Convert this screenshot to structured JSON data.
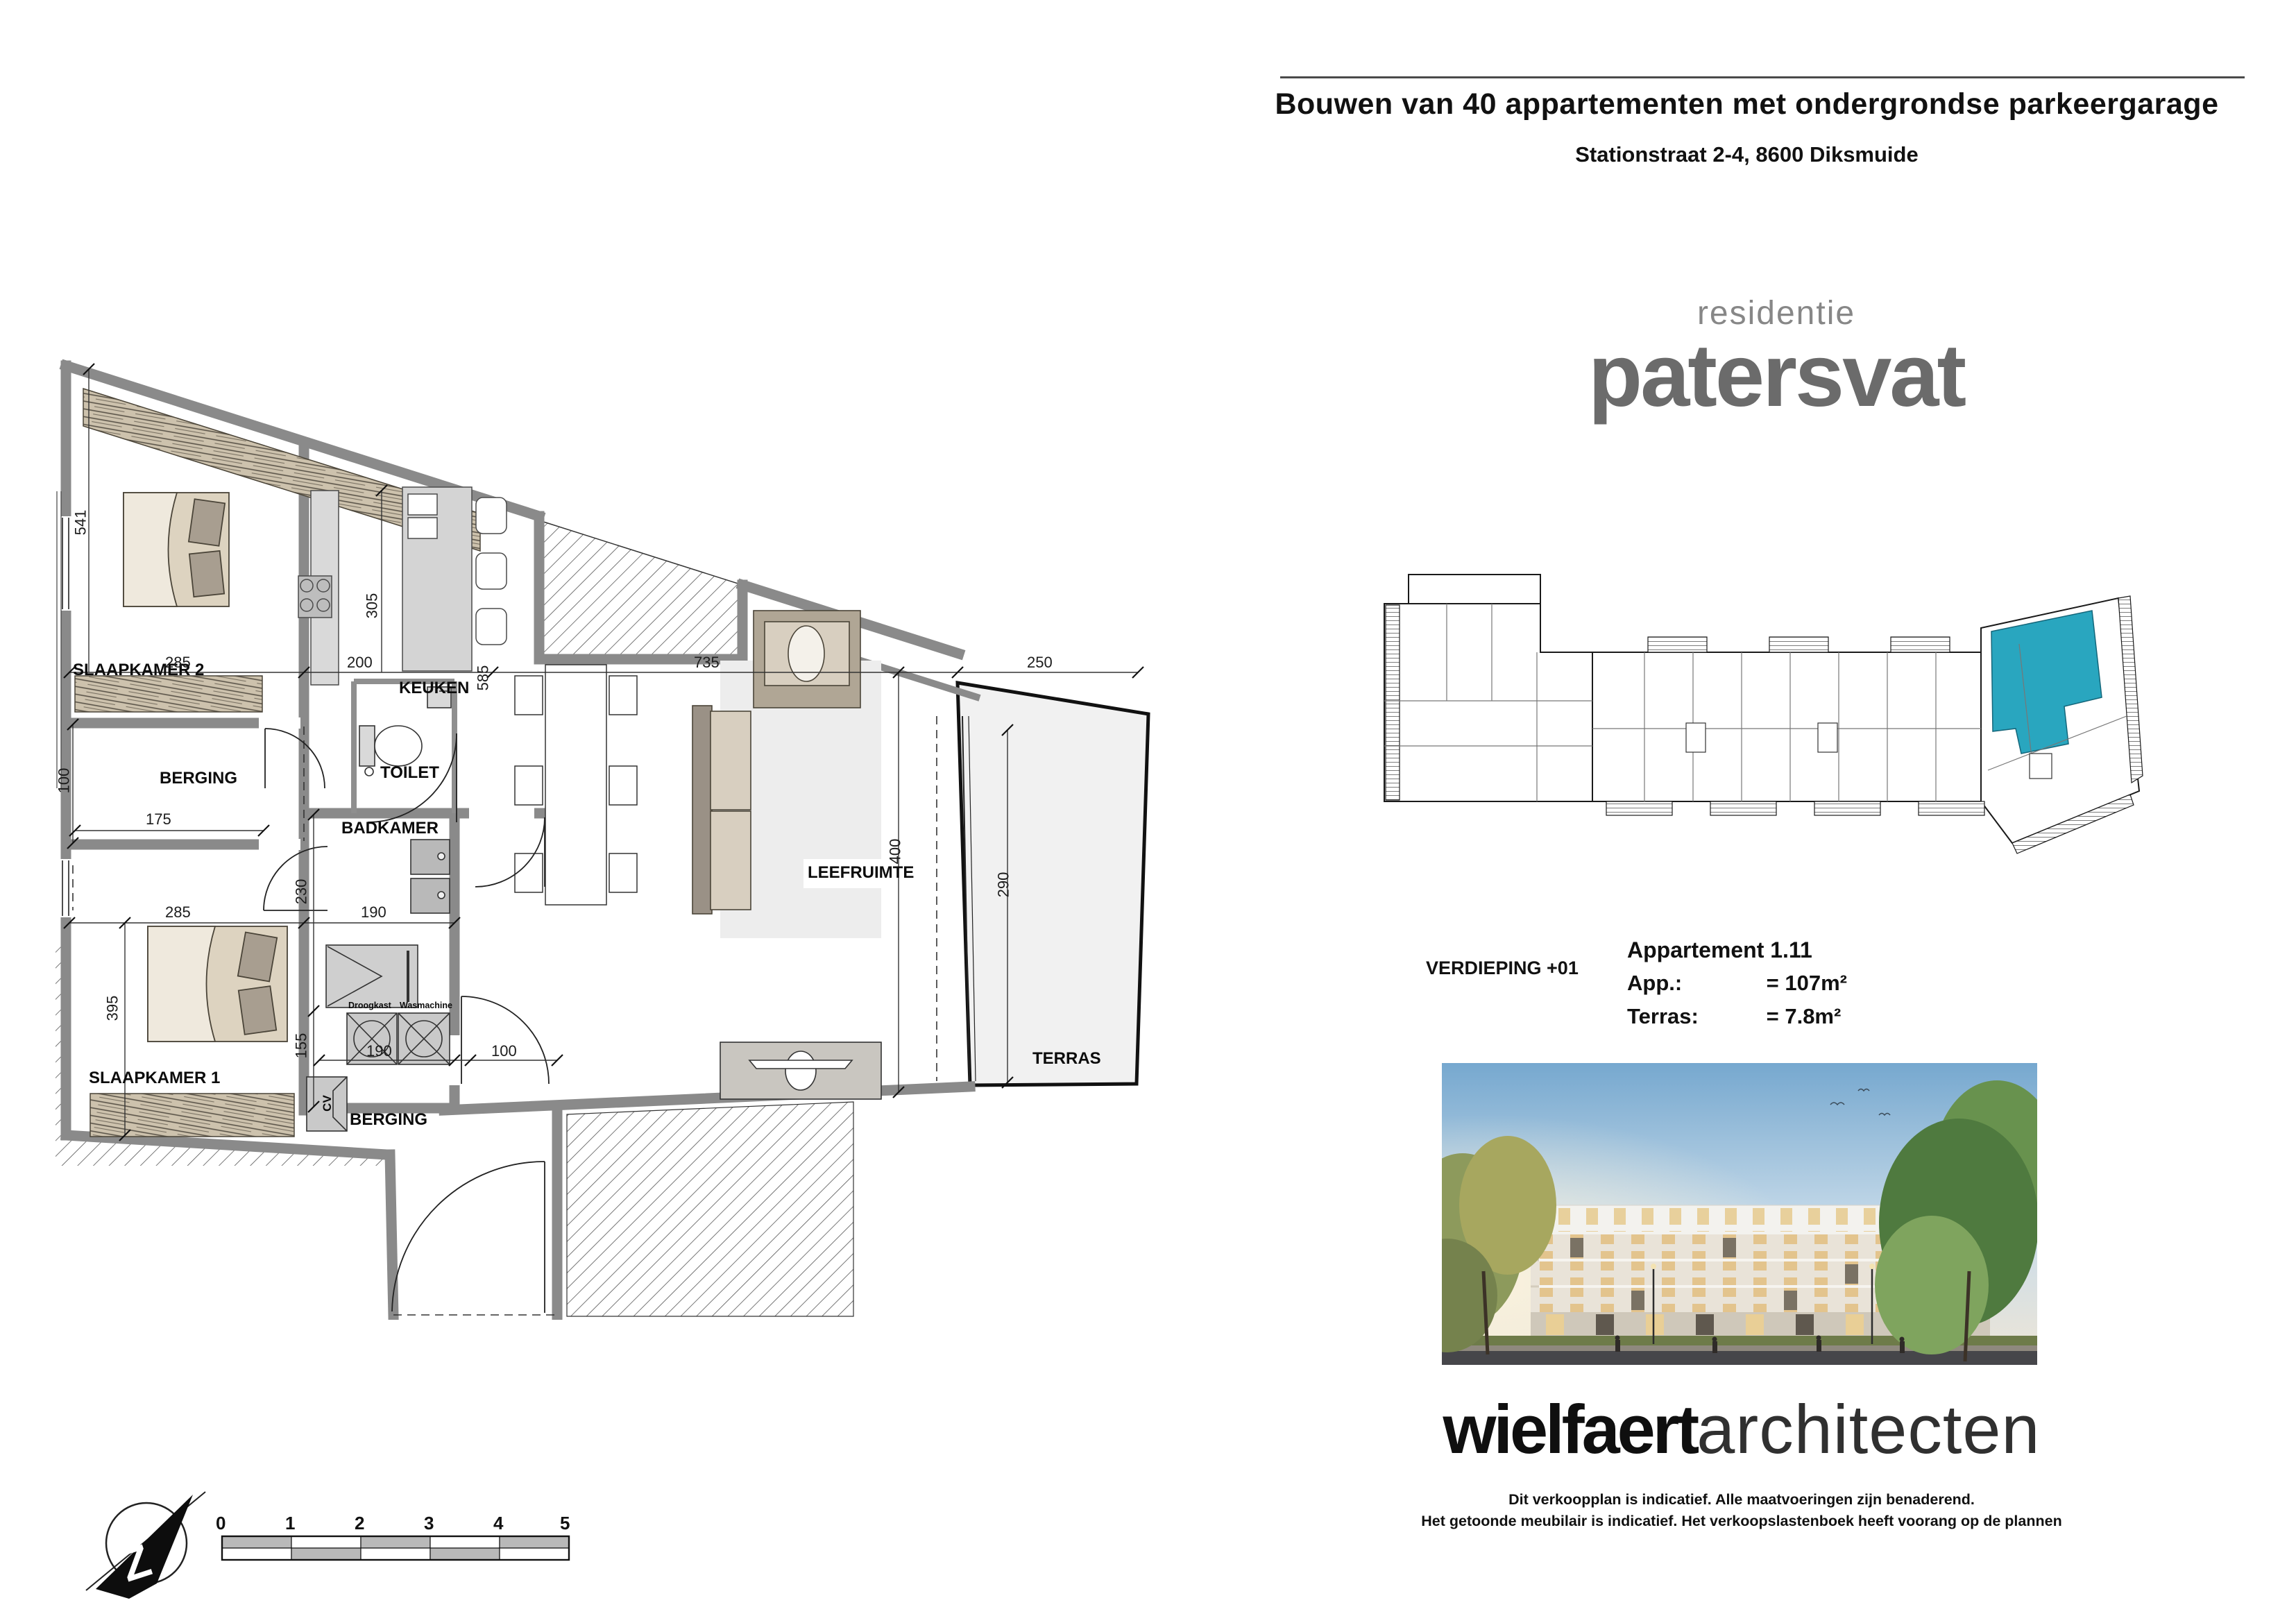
{
  "header": {
    "title": "Bouwen van 40 appartementen met ondergrondse parkeergarage",
    "address": "Stationstraat 2-4, 8600 Diksmuide"
  },
  "logo": {
    "top": "residentie",
    "name": "patersvat"
  },
  "overview": {
    "caption": "VERDIEPING +01",
    "highlight_color": "#29a6bf"
  },
  "apartment": {
    "title": "Appartement 1.11",
    "rows": [
      {
        "label": "App.:",
        "value": "= 107m²"
      },
      {
        "label": "Terras:",
        "value": "= 7.8m²"
      }
    ]
  },
  "brand": {
    "bold": "wielfaert",
    "light": "architecten"
  },
  "disclaimer": {
    "line1": "Dit verkoopplan is indicatief. Alle maatvoeringen zijn benaderend.",
    "line2": "Het getoonde meubilair is indicatief. Het verkoopslastenboek heeft voorang op de plannen"
  },
  "floorplan": {
    "rooms": {
      "slaapkamer2": "SLAAPKAMER 2",
      "berging1": "BERGING",
      "toilet": "TOILET",
      "badkamer": "BADKAMER",
      "slaapkamer1": "SLAAPKAMER 1",
      "berging2": "BERGING",
      "keuken": "KEUKEN",
      "leefruimte": "LEEFRUIMTE",
      "terras": "TERRAS"
    },
    "appliances": {
      "droogkast": "Droogkast",
      "wasmachine": "Wasmachine",
      "cv": "CV"
    },
    "dims": {
      "d541": "541",
      "d100l": "100",
      "d175": "175",
      "d285a": "285",
      "d200": "200",
      "d305": "305",
      "d585": "585",
      "d735": "735",
      "d250": "250",
      "d400": "400",
      "d290": "290",
      "d285b": "285",
      "d190a": "190",
      "d230": "230",
      "d395": "395",
      "d155": "155",
      "d190b": "190",
      "d100b": "100"
    }
  },
  "scalebar": {
    "labels": [
      "0",
      "1",
      "2",
      "3",
      "4",
      "5"
    ]
  },
  "compass": {
    "letter": "Z"
  }
}
